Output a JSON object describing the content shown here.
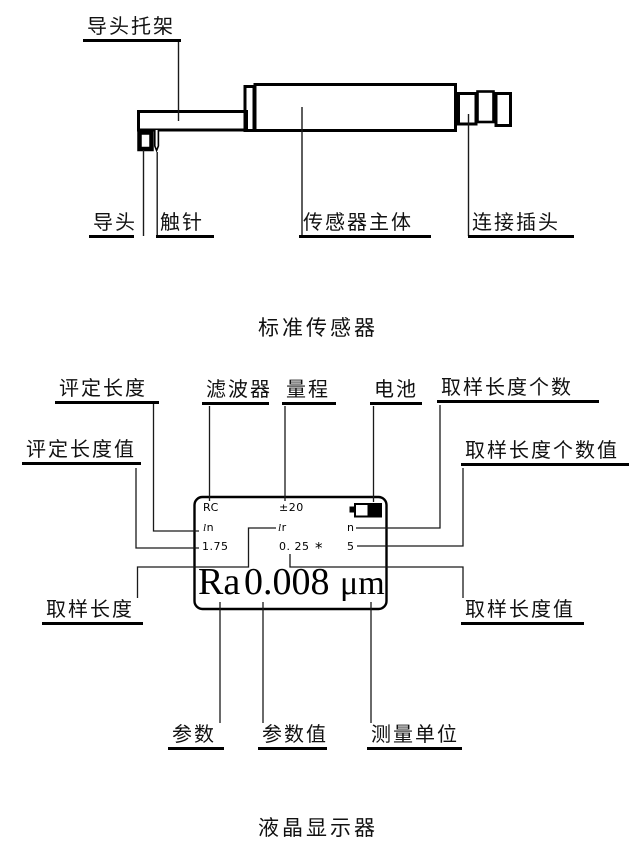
{
  "figure1": {
    "caption": "标准传感器",
    "labels": {
      "bracket": "导头托架",
      "guide_head": "导头",
      "stylus": "触针",
      "body": "传感器主体",
      "plug": "连接插头"
    }
  },
  "figure2": {
    "caption": "液晶显示器",
    "labels": {
      "evaluation_length": "评定长度",
      "filter": "滤波器",
      "range": "量程",
      "battery": "电池",
      "sampling_count": "取样长度个数",
      "evaluation_length_value": "评定长度值",
      "sampling_count_value": "取样长度个数值",
      "sampling_length": "取样长度",
      "sampling_length_value": "取样长度值",
      "parameter": "参数",
      "parameter_value": "参数值",
      "measurement_unit": "测量单位"
    },
    "lcd": {
      "filter_value": "RC",
      "range_value": "±20",
      "evaluation_length_symbol": "ln",
      "sampling_length_symbol": "lr",
      "sampling_count_symbol": "n",
      "evaluation_length_value": "1.75",
      "sampling_length_value": "0. 25",
      "multiply_symbol": "*",
      "sampling_count_value": "5",
      "parameter": "Ra",
      "parameter_value": "0.008",
      "unit": "μm"
    },
    "icons": {
      "battery": "battery-icon"
    },
    "colors": {
      "ink": "#000000"
    }
  }
}
